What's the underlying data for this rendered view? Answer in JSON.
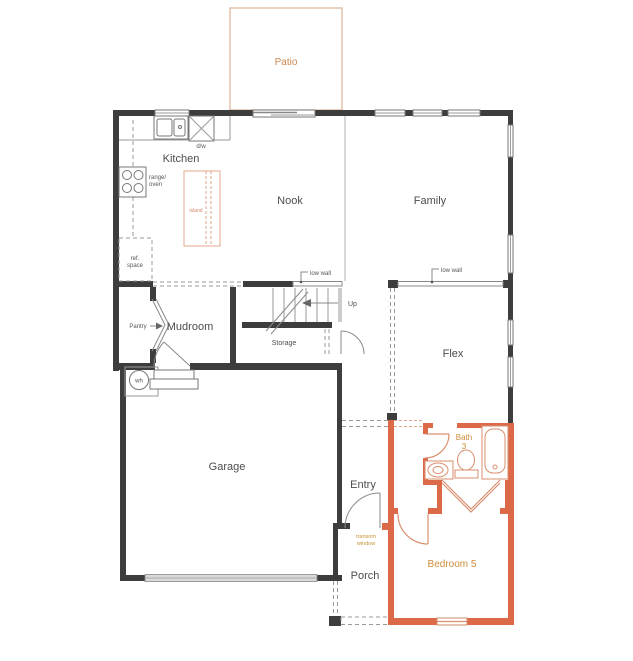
{
  "plan": {
    "rooms": {
      "patio": "Patio",
      "kitchen": "Kitchen",
      "nook": "Nook",
      "family": "Family",
      "pantry": "Pantry",
      "mudroom": "Mudroom",
      "storage": "Storage",
      "flex": "Flex",
      "garage": "Garage",
      "entry": "Entry",
      "porch": "Porch",
      "bath_line1": "Bath",
      "bath_line2": "3",
      "bedroom": "Bedroom 5"
    },
    "labels": {
      "up": "Up",
      "low_wall_stairs": "low wall",
      "low_wall_family": "low wall",
      "dw": "d/w",
      "range_line1": "range/",
      "range_line2": "oven",
      "ref_line1": "ref.",
      "ref_line2": "space",
      "island": "island",
      "wh": "wh",
      "transom_line1": "transom",
      "transom_line2": "window"
    },
    "colors": {
      "wall": "#3d3d3d",
      "orange_wall": "#dc6a48",
      "orange_text": "#cf8c3a",
      "gold_text": "#c49436",
      "patio_text": "#cc8850",
      "patio_outline": "#dfb89e",
      "text": "#4d4d4d"
    }
  }
}
